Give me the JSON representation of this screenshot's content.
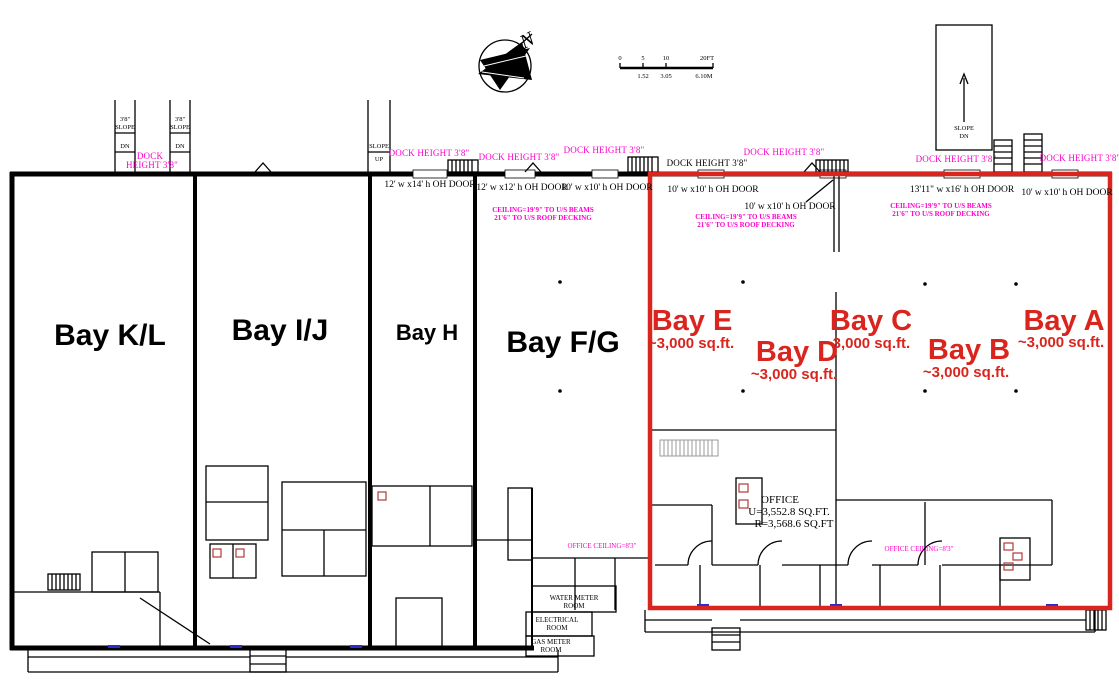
{
  "colors": {
    "wall_black": "#000000",
    "lease_outline_red": "#d9251d",
    "annotation_magenta": "#ff00cc",
    "fixture_red": "#b03a36",
    "door_threshold_blue": "#2a2ad0"
  },
  "compass": {
    "north": "N"
  },
  "scale_bar": {
    "ft0": "0",
    "ft5": "5",
    "ft10": "10",
    "ft20": "20FT",
    "m1": "1.52",
    "m2": "3.05",
    "m3": "6.10M"
  },
  "slopes": {
    "dock_ramp_grade": "3'8\"",
    "slope": "SLOPE",
    "dn": "DN",
    "up": "UP"
  },
  "dock_height_nw": {
    "line1": "DOCK",
    "line2": "HEIGHT 3'8\""
  },
  "dock_heights": [
    {
      "text": "DOCK HEIGHT 3'8\""
    },
    {
      "text": "DOCK HEIGHT 3'8\""
    },
    {
      "text": "DOCK HEIGHT 3'8\""
    },
    {
      "text": "DOCK HEIGHT 3'8\""
    },
    {
      "text": "DOCK HEIGHT 3'8\""
    },
    {
      "text": "DOCK HEIGHT 3'8\""
    },
    {
      "text": "DOCK HEIGHT 3'8\""
    }
  ],
  "oh_doors": [
    {
      "text": "12' w x14' h OH DOOR"
    },
    {
      "text": "12' w x12' h OH DOOR"
    },
    {
      "text": "10' w x10' h OH DOOR"
    },
    {
      "text": "10' w x10' h OH DOOR"
    },
    {
      "text": "10' w x10' h OH DOOR"
    },
    {
      "text": "13'11\" w x16' h OH DOOR"
    },
    {
      "text": "10' w x10' h OH DOOR"
    }
  ],
  "ceiling_note": {
    "line1": "CEILING=19'9\" TO U/S BEAMS",
    "line2": "21'6\" TO U/S ROOF DECKING"
  },
  "bays": {
    "existing": [
      {
        "label": "Bay K/L"
      },
      {
        "label": "Bay I/J"
      },
      {
        "label": "Bay H"
      },
      {
        "label": "Bay F/G"
      }
    ],
    "available": [
      {
        "label": "Bay E",
        "area": "~3,000 sq.ft."
      },
      {
        "label": "Bay D",
        "area": "~3,000 sq.ft."
      },
      {
        "label": "Bay C",
        "area": "~3,000 sq.ft."
      },
      {
        "label": "Bay B",
        "area": "~3,000 sq.ft."
      },
      {
        "label": "Bay A",
        "area": "~3,000 sq.ft."
      }
    ]
  },
  "office": {
    "title": "OFFICE",
    "usable": "U=3,552.8 SQ.FT.",
    "rentable": "R=3,568.6 SQ.FT"
  },
  "office_ceiling": {
    "text": "OFFICE CEILING=8'3\""
  },
  "utility_rooms": [
    {
      "line1": "WATER METER",
      "line2": "ROOM"
    },
    {
      "line1": "ELECTRICAL",
      "line2": "ROOM"
    },
    {
      "line1": "GAS METER",
      "line2": "ROOM"
    }
  ]
}
